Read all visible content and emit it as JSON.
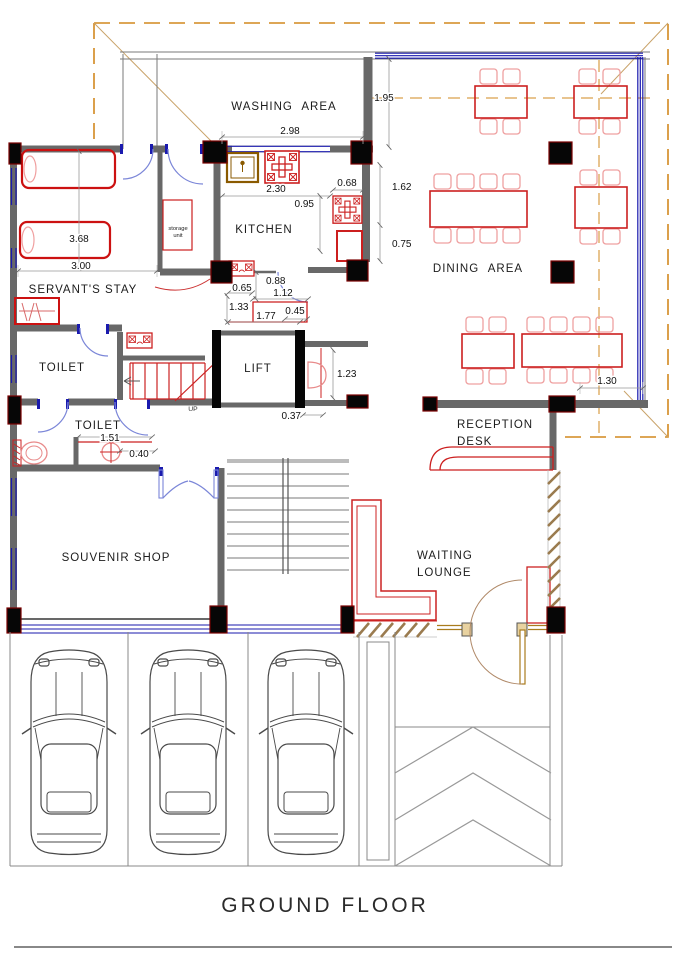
{
  "title": "GROUND FLOOR",
  "rooms": {
    "washing_area": "WASHING AREA",
    "kitchen": "KITCHEN",
    "dining_area": "DINING AREA",
    "servants_stay": "SERVANT'S STAY",
    "toilet_upper": "TOILET",
    "toilet_lower": "TOILET",
    "lift": "LIFT",
    "reception_line1": "RECEPTION",
    "reception_line2": "DESK",
    "waiting_line1": "WAITING",
    "waiting_line2": "LOUNGE",
    "souvenir_shop": "SOUVENIR SHOP",
    "storage_line1": "storage",
    "storage_line2": "unit",
    "up": "UP"
  },
  "dimensions": {
    "dining_top": "1.95",
    "washing_window": "2.98",
    "kitchen_counter": "2.30",
    "kitchen_gap": "0.68",
    "kitchen_side_upper": "1.62",
    "kitchen_depth": "0.95",
    "kitchen_side_lower": "0.75",
    "servants_length": "3.68",
    "servants_width": "3.00",
    "pantry_a": "0.65",
    "pantry_b": "0.88",
    "pantry_c": "1.12",
    "pantry_d": "1.33",
    "pantry_e": "1.77",
    "pantry_f": "0.45",
    "lift_lobby": "1.23",
    "lift_wall": "0.37",
    "dining_column": "1.30",
    "toilet_width": "1.51",
    "basin_offset": "0.40"
  },
  "colors": {
    "wall_gray": "#686868",
    "column_black": "#060606",
    "column_edge_red": "#7a0000",
    "furniture_red": "#cc1f1f",
    "chair_pink": "#efA0a0",
    "window_blue": "#1a1aae",
    "door_blue": "#7b86d8",
    "canopy_orange": "#d2881f",
    "diagonal_tan": "#c9a36a",
    "hatch_brown": "#9a7b4f",
    "entrance_gold": "#a97c1e",
    "sink_brown": "#8a5a00",
    "car_gray": "#4a4a4a",
    "dim_gray": "#999999"
  }
}
